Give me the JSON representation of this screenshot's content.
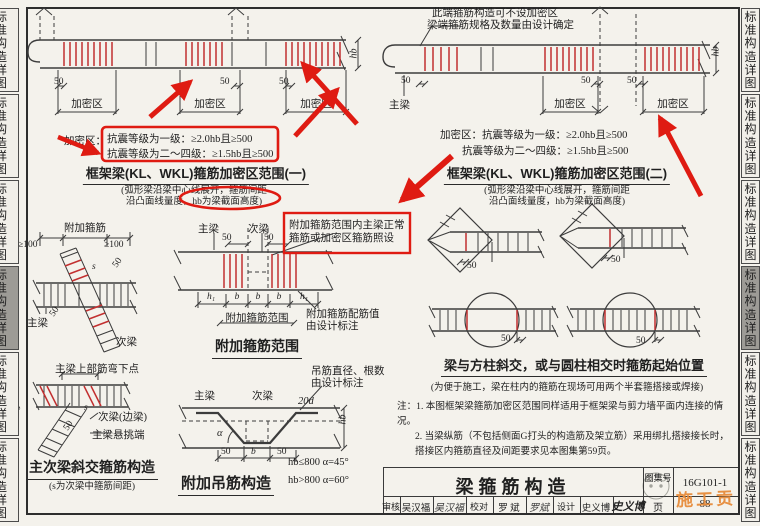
{
  "colors": {
    "annotation_red": "#df1b12",
    "stirrup_red": "#c23030",
    "watermark_orange": "#e78b3a",
    "active_tab_gray": "#9d9b96"
  },
  "sidebar": {
    "tab_label": "标准构造详图"
  },
  "d1": {
    "dim50": "50",
    "zone": "加密区",
    "hb": "hb",
    "crit_prefix": "加密区：",
    "crit1": "抗震等级为一级：≥2.0hb且≥500",
    "crit2": "抗震等级为二～四级：≥1.5hb且≥500",
    "title": "框架梁(KL、WKL)箍筋加密区范围(一)",
    "sub1": "(弧形梁沿梁中心线展开，箍筋间距",
    "sub2": "沿凸面线量度，hb为梁截面高度)"
  },
  "d2": {
    "callout1": "此端箍筋构造可不设加密区",
    "callout2": "梁端箍筋规格及数量由设计确定",
    "girder": "主梁",
    "dim50": "50",
    "zone": "加密区",
    "hb": "hb",
    "crit1": "加密区：抗震等级为一级：≥2.0hb且≥500",
    "crit2": "抗震等级为二～四级：≥1.5hb且≥500",
    "title": "框架梁(KL、WKL)箍筋加密区范围(二)",
    "sub1": "(弧形梁沿梁中心线展开，箍筋间距",
    "sub2": "沿凸面线量度，hb为梁截面高度)"
  },
  "d3": {
    "label": "附加箍筋",
    "dim100": "≥100",
    "dim50": "50",
    "s": "s",
    "girder": "主梁",
    "secondary": "次梁"
  },
  "d4": {
    "bend_note": "主梁上部筋弯下点",
    "dim50": "50",
    "s": "s",
    "secondary": "次梁(边梁)",
    "cantilever": "主梁悬挑端",
    "title": "主次梁斜交箍筋构造",
    "subtitle": "(s为次梁中箍筋间距)"
  },
  "d5": {
    "girder": "主梁",
    "secondary": "次梁",
    "dim50": "50",
    "note1": "附加箍筋范围内主梁正常",
    "note2": "箍筋或加密区箍筋照设",
    "h1": "h₁",
    "b": "b",
    "range_label": "附加箍筋范围",
    "cfg1": "附加箍筋配筋值",
    "cfg2": "由设计标注",
    "title": "附加箍筋范围"
  },
  "d6": {
    "note1": "吊筋直径、根数",
    "note2": "由设计标注",
    "girder": "主梁",
    "secondary": "次梁",
    "dim20d": "20d",
    "alpha": "α",
    "dim50": "50",
    "dimb": "b",
    "hb": "hb",
    "rule1": "hb≤800  α=45°",
    "rule2": "hb>800  α=60°",
    "title": "附加吊筋构造"
  },
  "d7": {
    "dim50": "50",
    "title": "梁与方柱斜交，或与圆柱相交时箍筋起始位置",
    "subtitle": "(为便于施工，梁在柱内的箍筋在现场可用两个半套箍搭接或焊接)"
  },
  "notes": {
    "line1": "注：1. 本图框架梁箍筋加密区范围同样适用于框架梁与剪力墙平面内连接的情况。",
    "line2": "2. 当梁纵筋（不包括侧面G打头的构造筋及架立筋）采用绑扎搭接接长时，搭接区内箍筋直径及间距要求见本图集第59页。"
  },
  "titleblock": {
    "sheet_title": "梁箍筋构造",
    "atlas_label": "图集号",
    "atlas_no": "16G101-1",
    "page_label": "页",
    "page_number": "88",
    "review_label": "审核",
    "review_name": "吴汉福",
    "review_sign": "吴汉福",
    "check_label": "校对",
    "check_name": "罗 斌",
    "check_sign": "罗斌",
    "design_label": "设计",
    "design_name": "史义博",
    "design_sign": "史义博",
    "watermark": "施工贡"
  }
}
